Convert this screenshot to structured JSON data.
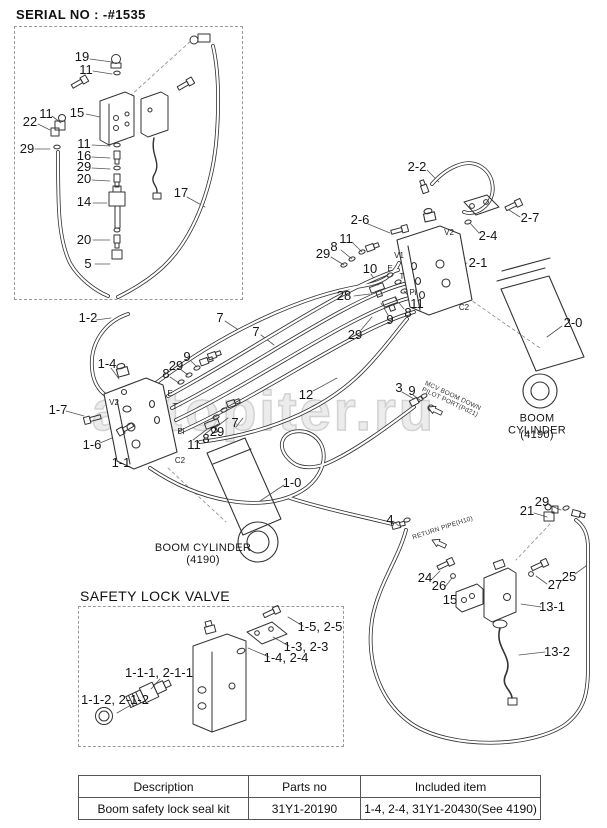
{
  "header": {
    "serial_no": "SERIAL NO : -#1535"
  },
  "watermark": "autopiter.ru",
  "safety_box": {
    "title": "SAFETY LOCK VALVE"
  },
  "labels": [
    {
      "t": "19",
      "x": 82,
      "y": 57
    },
    {
      "t": "11",
      "x": 86,
      "y": 70
    },
    {
      "t": "15",
      "x": 77,
      "y": 113
    },
    {
      "t": "11",
      "x": 46,
      "y": 114
    },
    {
      "t": "22",
      "x": 30,
      "y": 122
    },
    {
      "t": "29",
      "x": 27,
      "y": 149
    },
    {
      "t": "11",
      "x": 84,
      "y": 144
    },
    {
      "t": "16",
      "x": 84,
      "y": 156
    },
    {
      "t": "29",
      "x": 84,
      "y": 167
    },
    {
      "t": "20",
      "x": 84,
      "y": 179
    },
    {
      "t": "14",
      "x": 84,
      "y": 202
    },
    {
      "t": "20",
      "x": 84,
      "y": 240
    },
    {
      "t": "5",
      "x": 88,
      "y": 264
    },
    {
      "t": "17",
      "x": 181,
      "y": 193
    },
    {
      "t": "2-2",
      "x": 417,
      "y": 167
    },
    {
      "t": "2-6",
      "x": 360,
      "y": 220
    },
    {
      "t": "2-7",
      "x": 530,
      "y": 218
    },
    {
      "t": "2-4",
      "x": 488,
      "y": 236
    },
    {
      "t": "2-1",
      "x": 478,
      "y": 263
    },
    {
      "t": "2-0",
      "x": 573,
      "y": 323
    },
    {
      "t": "11",
      "x": 346,
      "y": 239
    },
    {
      "t": "8",
      "x": 334,
      "y": 247
    },
    {
      "t": "29",
      "x": 323,
      "y": 254
    },
    {
      "t": "10",
      "x": 370,
      "y": 269
    },
    {
      "t": "28",
      "x": 344,
      "y": 296
    },
    {
      "t": "9",
      "x": 390,
      "y": 320
    },
    {
      "t": "29",
      "x": 355,
      "y": 335
    },
    {
      "t": "8",
      "x": 408,
      "y": 313
    },
    {
      "t": "11",
      "x": 417,
      "y": 304
    },
    {
      "t": "7",
      "x": 220,
      "y": 318
    },
    {
      "t": "7",
      "x": 256,
      "y": 332
    },
    {
      "t": "9",
      "x": 187,
      "y": 357
    },
    {
      "t": "29",
      "x": 176,
      "y": 366
    },
    {
      "t": "8",
      "x": 166,
      "y": 374
    },
    {
      "t": "1-2",
      "x": 88,
      "y": 318
    },
    {
      "t": "1-4",
      "x": 107,
      "y": 364
    },
    {
      "t": "1-7",
      "x": 58,
      "y": 410
    },
    {
      "t": "1-6",
      "x": 92,
      "y": 445
    },
    {
      "t": "1-1",
      "x": 121,
      "y": 463
    },
    {
      "t": "1-0",
      "x": 292,
      "y": 483
    },
    {
      "t": "12",
      "x": 306,
      "y": 395
    },
    {
      "t": "3",
      "x": 399,
      "y": 388
    },
    {
      "t": "9",
      "x": 412,
      "y": 391
    },
    {
      "t": "29",
      "x": 217,
      "y": 432
    },
    {
      "t": "8",
      "x": 206,
      "y": 439
    },
    {
      "t": "11",
      "x": 194,
      "y": 445
    },
    {
      "t": "7",
      "x": 235,
      "y": 423
    },
    {
      "t": "4",
      "x": 390,
      "y": 520
    },
    {
      "t": "21",
      "x": 527,
      "y": 511
    },
    {
      "t": "29",
      "x": 542,
      "y": 502
    },
    {
      "t": "24",
      "x": 425,
      "y": 578
    },
    {
      "t": "26",
      "x": 439,
      "y": 586
    },
    {
      "t": "15",
      "x": 450,
      "y": 600
    },
    {
      "t": "27",
      "x": 555,
      "y": 585
    },
    {
      "t": "25",
      "x": 569,
      "y": 577
    },
    {
      "t": "13-1",
      "x": 552,
      "y": 607
    },
    {
      "t": "13-2",
      "x": 557,
      "y": 652
    },
    {
      "t": "1-5, 2-5",
      "x": 320,
      "y": 627
    },
    {
      "t": "1-3, 2-3",
      "x": 306,
      "y": 647
    },
    {
      "t": "1-4, 2-4",
      "x": 286,
      "y": 658
    },
    {
      "t": "1-1-1, 2-1-1",
      "x": 159,
      "y": 673
    },
    {
      "t": "1-1-2, 2-1-2",
      "x": 115,
      "y": 700
    },
    {
      "t": "V2",
      "x": 114,
      "y": 403,
      "c": "p"
    },
    {
      "t": "E",
      "x": 170,
      "y": 394,
      "c": "p"
    },
    {
      "t": "T",
      "x": 175,
      "y": 407,
      "c": "p"
    },
    {
      "t": "Pi",
      "x": 181,
      "y": 432,
      "c": "p"
    },
    {
      "t": "C2",
      "x": 180,
      "y": 461,
      "c": "p"
    },
    {
      "t": "V2",
      "x": 449,
      "y": 233,
      "c": "p"
    },
    {
      "t": "V1",
      "x": 399,
      "y": 256,
      "c": "p"
    },
    {
      "t": "E",
      "x": 390,
      "y": 269,
      "c": "p"
    },
    {
      "t": "T",
      "x": 402,
      "y": 277,
      "c": "p"
    },
    {
      "t": "Pi",
      "x": 413,
      "y": 293,
      "c": "p"
    },
    {
      "t": "C2",
      "x": 464,
      "y": 308,
      "c": "p"
    },
    {
      "t": "BOOM CYLINDER",
      "x": 203,
      "y": 549,
      "c": "m"
    },
    {
      "t": "(4190)",
      "x": 203,
      "y": 561,
      "c": "m"
    },
    {
      "t": "BOOM CYLINDER",
      "x": 537,
      "y": 425,
      "c": "m"
    },
    {
      "t": "(4190)",
      "x": 537,
      "y": 436,
      "c": "m"
    },
    {
      "t": "MCV BOOM DOWN\nPILOT PORT(Pd21)",
      "x": 451,
      "y": 400,
      "c": "r",
      "r": 25
    },
    {
      "t": "RETURN PIPE(H10)",
      "x": 443,
      "y": 529,
      "c": "r",
      "r": -18
    }
  ],
  "table": {
    "headers": [
      "Description",
      "Parts no",
      "Included item"
    ],
    "rows": [
      [
        "Boom safety lock seal kit",
        "31Y1-20190",
        "1-4, 2-4, 31Y1-20430(See 4190)"
      ]
    ]
  }
}
